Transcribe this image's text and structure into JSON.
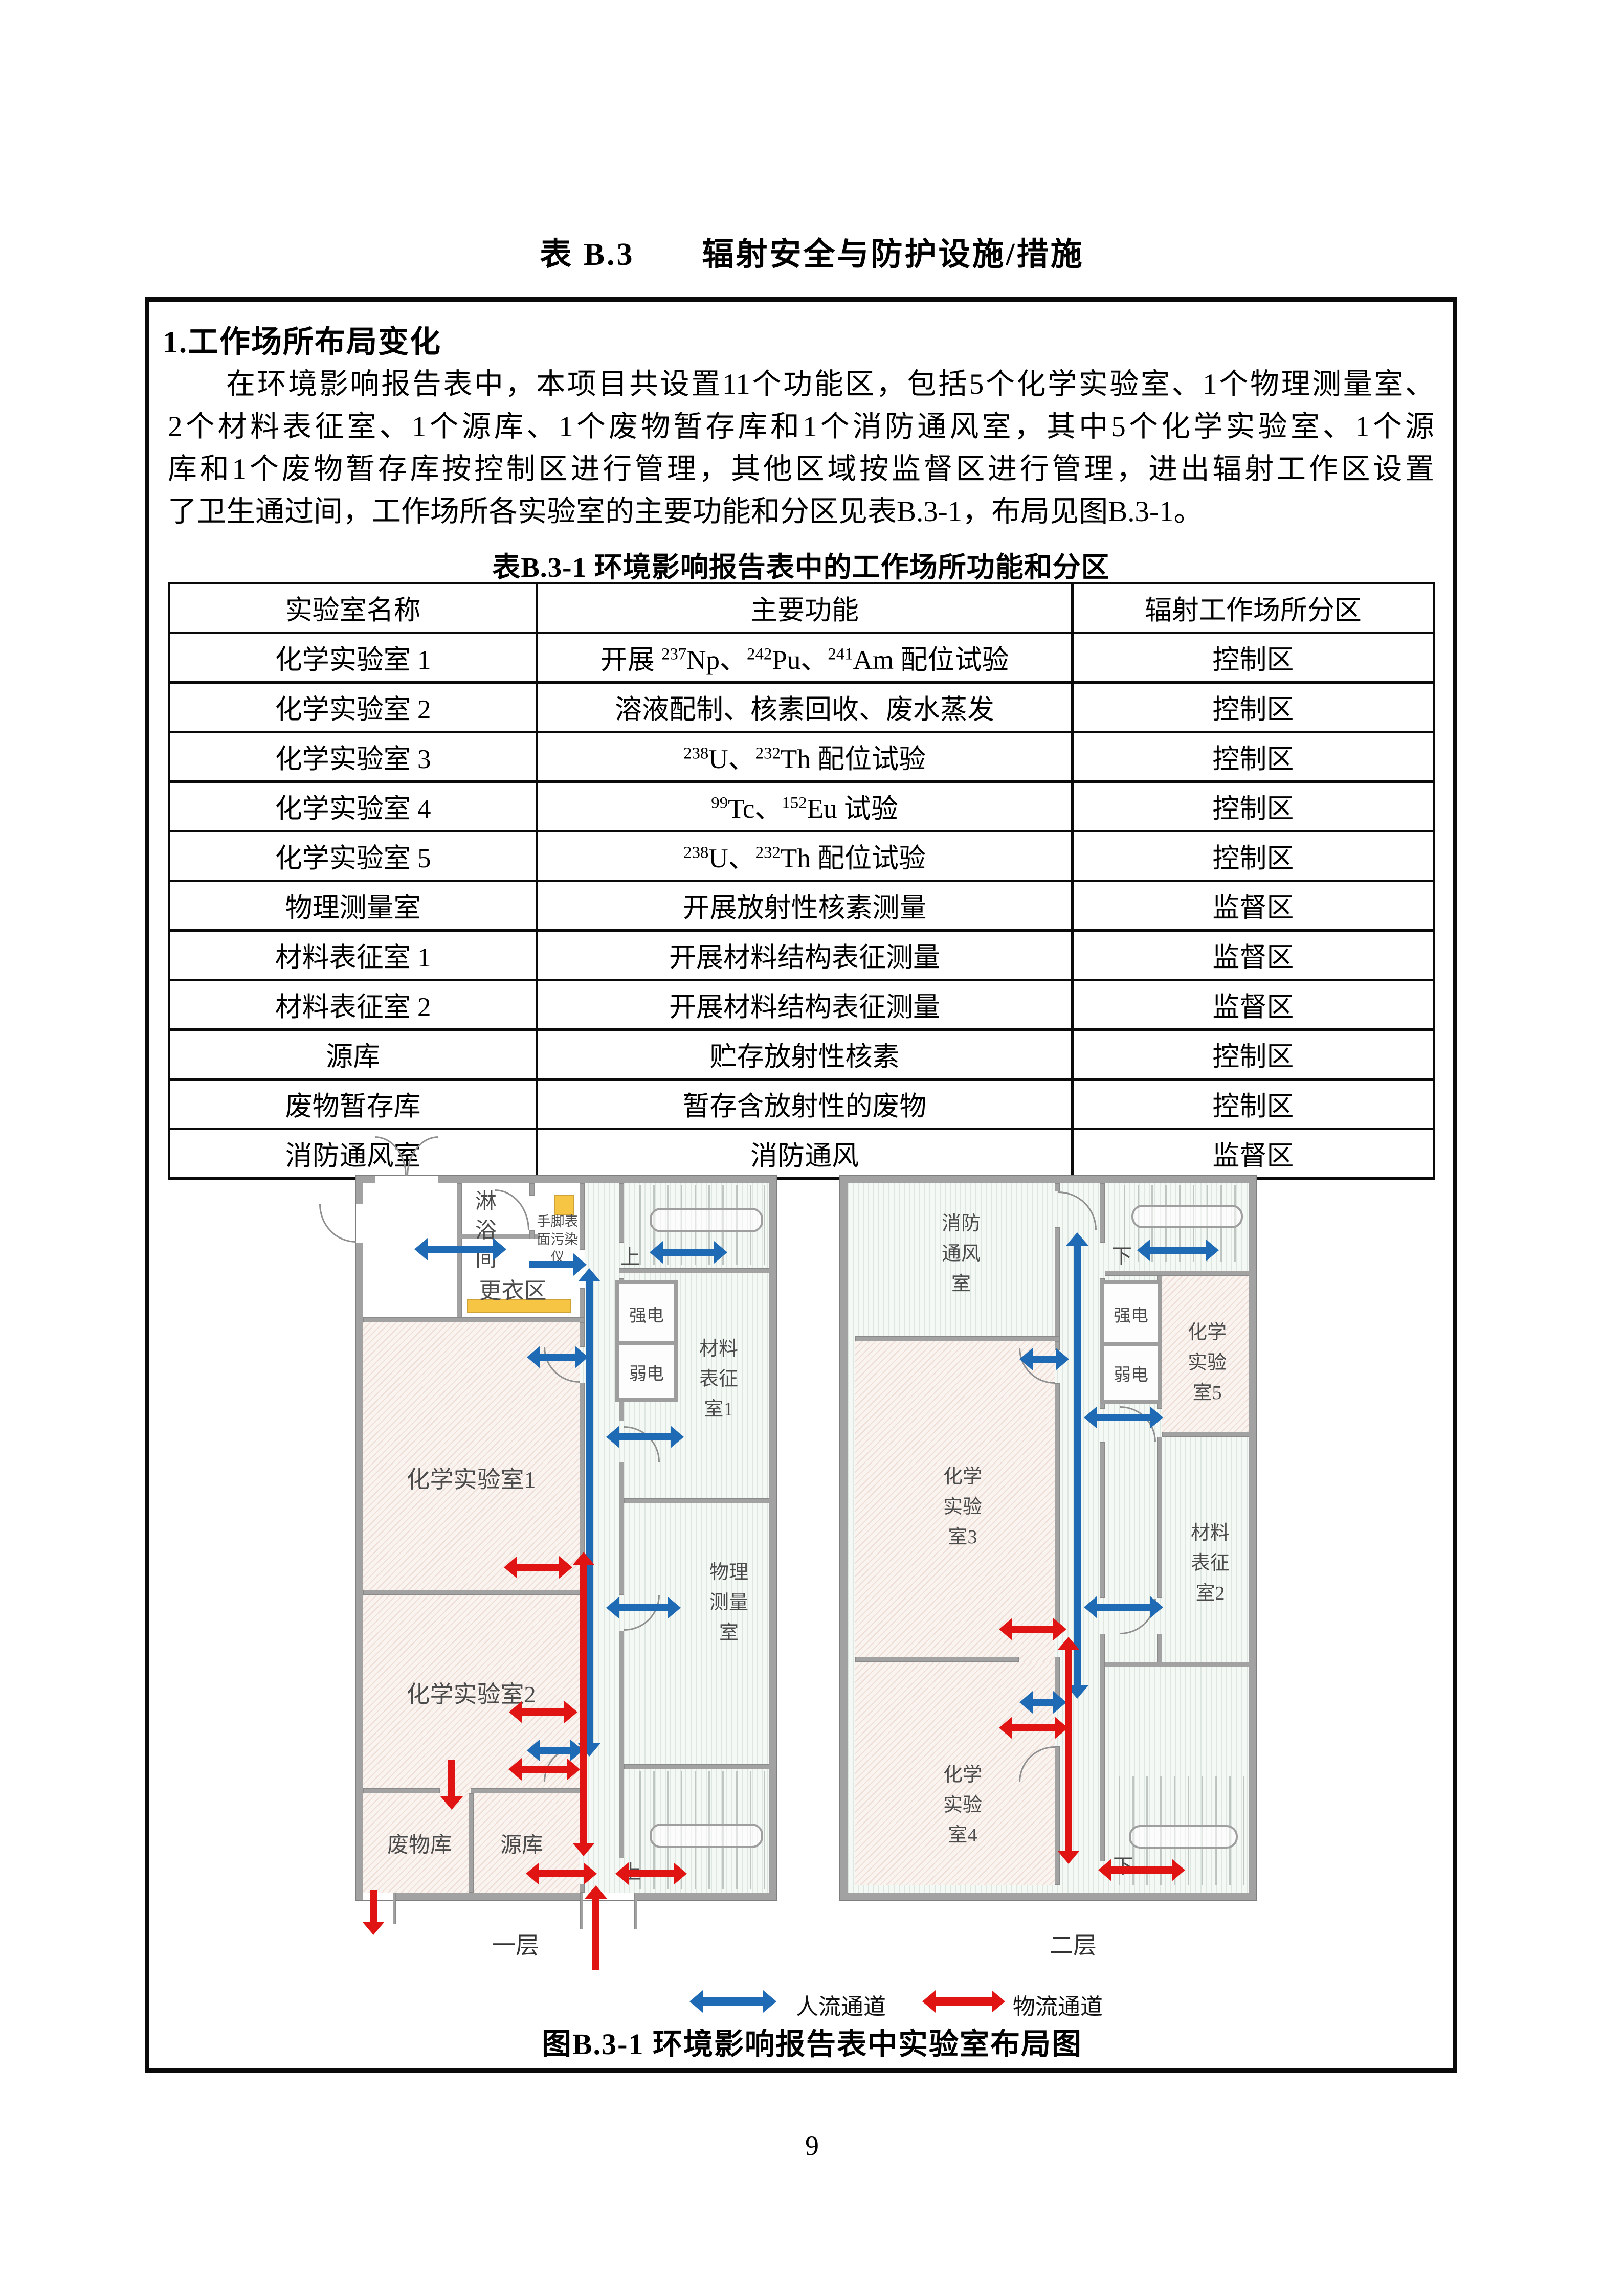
{
  "page": {
    "title": "表 B.3　　辐射安全与防护设施/措施",
    "number": "9"
  },
  "section": {
    "heading": "1.工作场所布局变化"
  },
  "paragraph": {
    "lines": [
      "在环境影响报告表中，本项目共设置11个功能区，包括5个化学实验室、1个物理测量室、",
      "2个材料表征室、1个源库、1个废物暂存库和1个消防通风室，其中5个化学实验室、1个源",
      "库和1个废物暂存库按控制区进行管理，其他区域按监督区进行管理，进出辐射工作区设置",
      "了卫生通过间，工作场所各实验室的主要功能和分区见表B.3-1，布局见图B.3-1。"
    ]
  },
  "table": {
    "caption": "表B.3-1 环境影响报告表中的工作场所功能和分区",
    "headers": [
      "实验室名称",
      "主要功能",
      "辐射工作场所分区"
    ],
    "rows": [
      {
        "name": "化学实验室 1",
        "func": [
          [
            "t",
            "开展 "
          ],
          [
            "s",
            "237"
          ],
          [
            "t",
            "Np、"
          ],
          [
            "s",
            "242"
          ],
          [
            "t",
            "Pu、"
          ],
          [
            "s",
            "241"
          ],
          [
            "t",
            "Am 配位试验"
          ]
        ],
        "zone": "控制区"
      },
      {
        "name": "化学实验室 2",
        "func": [
          [
            "t",
            "溶液配制、核素回收、废水蒸发"
          ]
        ],
        "zone": "控制区"
      },
      {
        "name": "化学实验室 3",
        "func": [
          [
            "s",
            "238"
          ],
          [
            "t",
            "U、"
          ],
          [
            "s",
            "232"
          ],
          [
            "t",
            "Th 配位试验"
          ]
        ],
        "zone": "控制区"
      },
      {
        "name": "化学实验室 4",
        "func": [
          [
            "s",
            "99"
          ],
          [
            "t",
            "Tc、"
          ],
          [
            "s",
            "152"
          ],
          [
            "t",
            "Eu 试验"
          ]
        ],
        "zone": "控制区"
      },
      {
        "name": "化学实验室 5",
        "func": [
          [
            "s",
            "238"
          ],
          [
            "t",
            "U、"
          ],
          [
            "s",
            "232"
          ],
          [
            "t",
            "Th 配位试验"
          ]
        ],
        "zone": "控制区"
      },
      {
        "name": "物理测量室",
        "func": [
          [
            "t",
            "开展放射性核素测量"
          ]
        ],
        "zone": "监督区"
      },
      {
        "name": "材料表征室 1",
        "func": [
          [
            "t",
            "开展材料结构表征测量"
          ]
        ],
        "zone": "监督区"
      },
      {
        "name": "材料表征室 2",
        "func": [
          [
            "t",
            "开展材料结构表征测量"
          ]
        ],
        "zone": "监督区"
      },
      {
        "name": "源库",
        "func": [
          [
            "t",
            "贮存放射性核素"
          ]
        ],
        "zone": "控制区"
      },
      {
        "name": "废物暂存库",
        "func": [
          [
            "t",
            "暂存含放射性的废物"
          ]
        ],
        "zone": "控制区"
      },
      {
        "name": "消防通风室",
        "func": [
          [
            "t",
            "消防通风"
          ]
        ],
        "zone": "监督区"
      }
    ]
  },
  "floorplan": {
    "caption": "图B.3-1 环境影响报告表中实验室布局图",
    "legend": {
      "people": "人流通道",
      "material": "物流通道"
    },
    "colors": {
      "people_flow": "#1e6ab5",
      "material_flow": "#e01412",
      "wall": "#a2a2a2",
      "marker_yellow": "#f6c544"
    },
    "floor1": {
      "caption": "一层",
      "rooms": {
        "shower": "淋\n浴\n间",
        "contamination_monitor": "手脚表\n面污染\n仪",
        "changing_area": "更衣区",
        "chem_lab_1": "化学实验室1",
        "chem_lab_2": "化学实验室2",
        "waste_store": "废物库",
        "source_store": "源库",
        "strong_power": "强电",
        "weak_power": "弱电",
        "material_room_1": "材料\n表征\n室1",
        "physics_room": "物理\n测量\n室",
        "stairs_up_top": "上",
        "stairs_up_bottom": "上"
      }
    },
    "floor2": {
      "caption": "二层",
      "rooms": {
        "fire_vent_room": "消防\n通风\n室",
        "chem_lab_3": "化学\n实验\n室3",
        "chem_lab_4": "化学\n实验\n室4",
        "strong_power": "强电",
        "weak_power": "弱电",
        "chem_lab_5": "化学\n实验\n室5",
        "material_room_2": "材料\n表征\n室2",
        "stairs_down_top": "下",
        "stairs_down_bottom": "下"
      }
    }
  }
}
